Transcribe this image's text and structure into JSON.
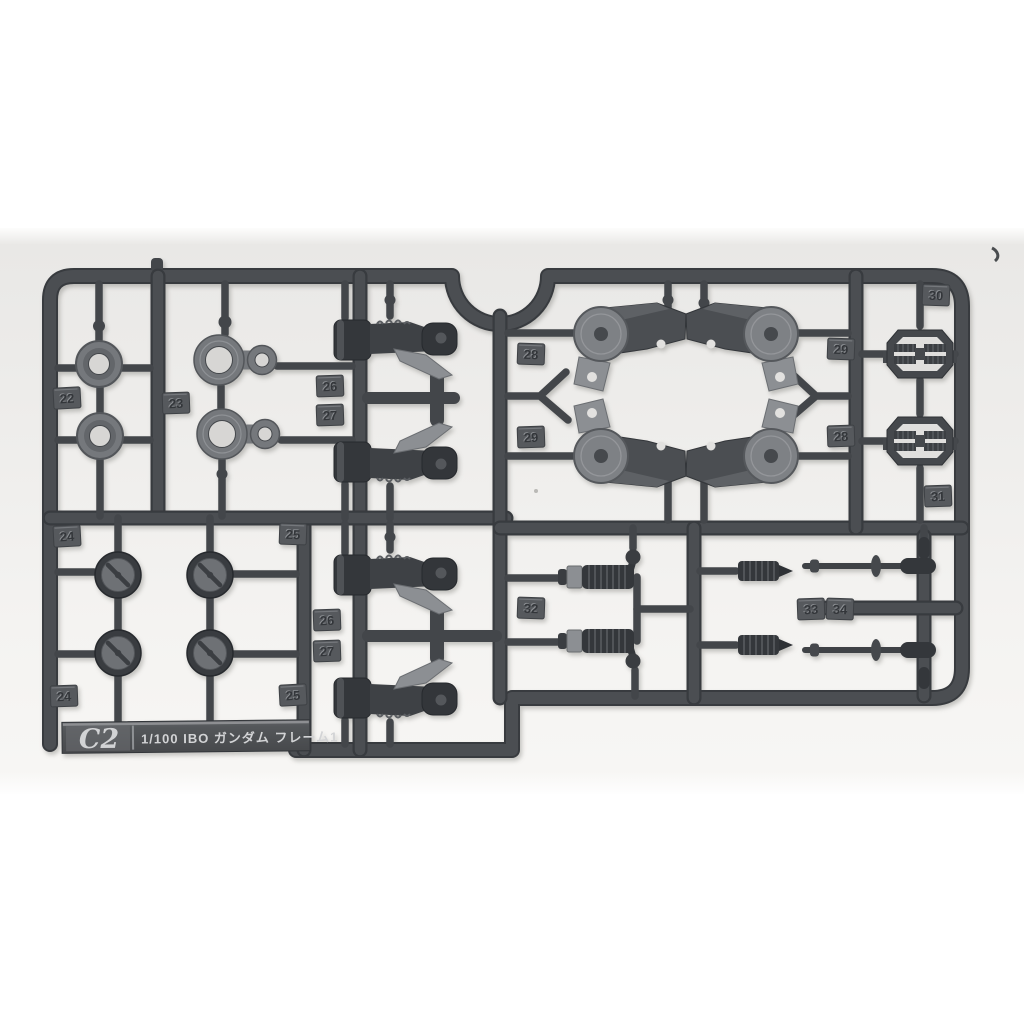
{
  "label_plate": {
    "code": "C2",
    "description": "1/100 IBO ガンダム フレーム1"
  },
  "part_tags": [
    {
      "label": "22"
    },
    {
      "label": "23"
    },
    {
      "label": "26"
    },
    {
      "label": "27"
    },
    {
      "label": "28"
    },
    {
      "label": "29"
    },
    {
      "label": "29"
    },
    {
      "label": "28"
    },
    {
      "label": "30"
    },
    {
      "label": "31"
    },
    {
      "label": "24"
    },
    {
      "label": "25"
    },
    {
      "label": "24"
    },
    {
      "label": "25"
    },
    {
      "label": "26"
    },
    {
      "label": "27"
    },
    {
      "label": "32"
    },
    {
      "label": "33"
    },
    {
      "label": "34"
    }
  ],
  "colors": {
    "backdrop": "#e9e8e6",
    "backdrop_bright": "#f4f3f1",
    "runner": "#4b4e52",
    "runner_edge": "#383b3f",
    "gate": "#43464a",
    "part_dark": "#34373b",
    "part_light": "#8c8f93",
    "part_pale": "#75787c",
    "hole": "#d7d6d4",
    "tag": "#56595d",
    "tag_text": "#33363a",
    "plate_top": "#606366",
    "plate_bottom": "#47494c",
    "plate_text": "#d2d3d5"
  }
}
